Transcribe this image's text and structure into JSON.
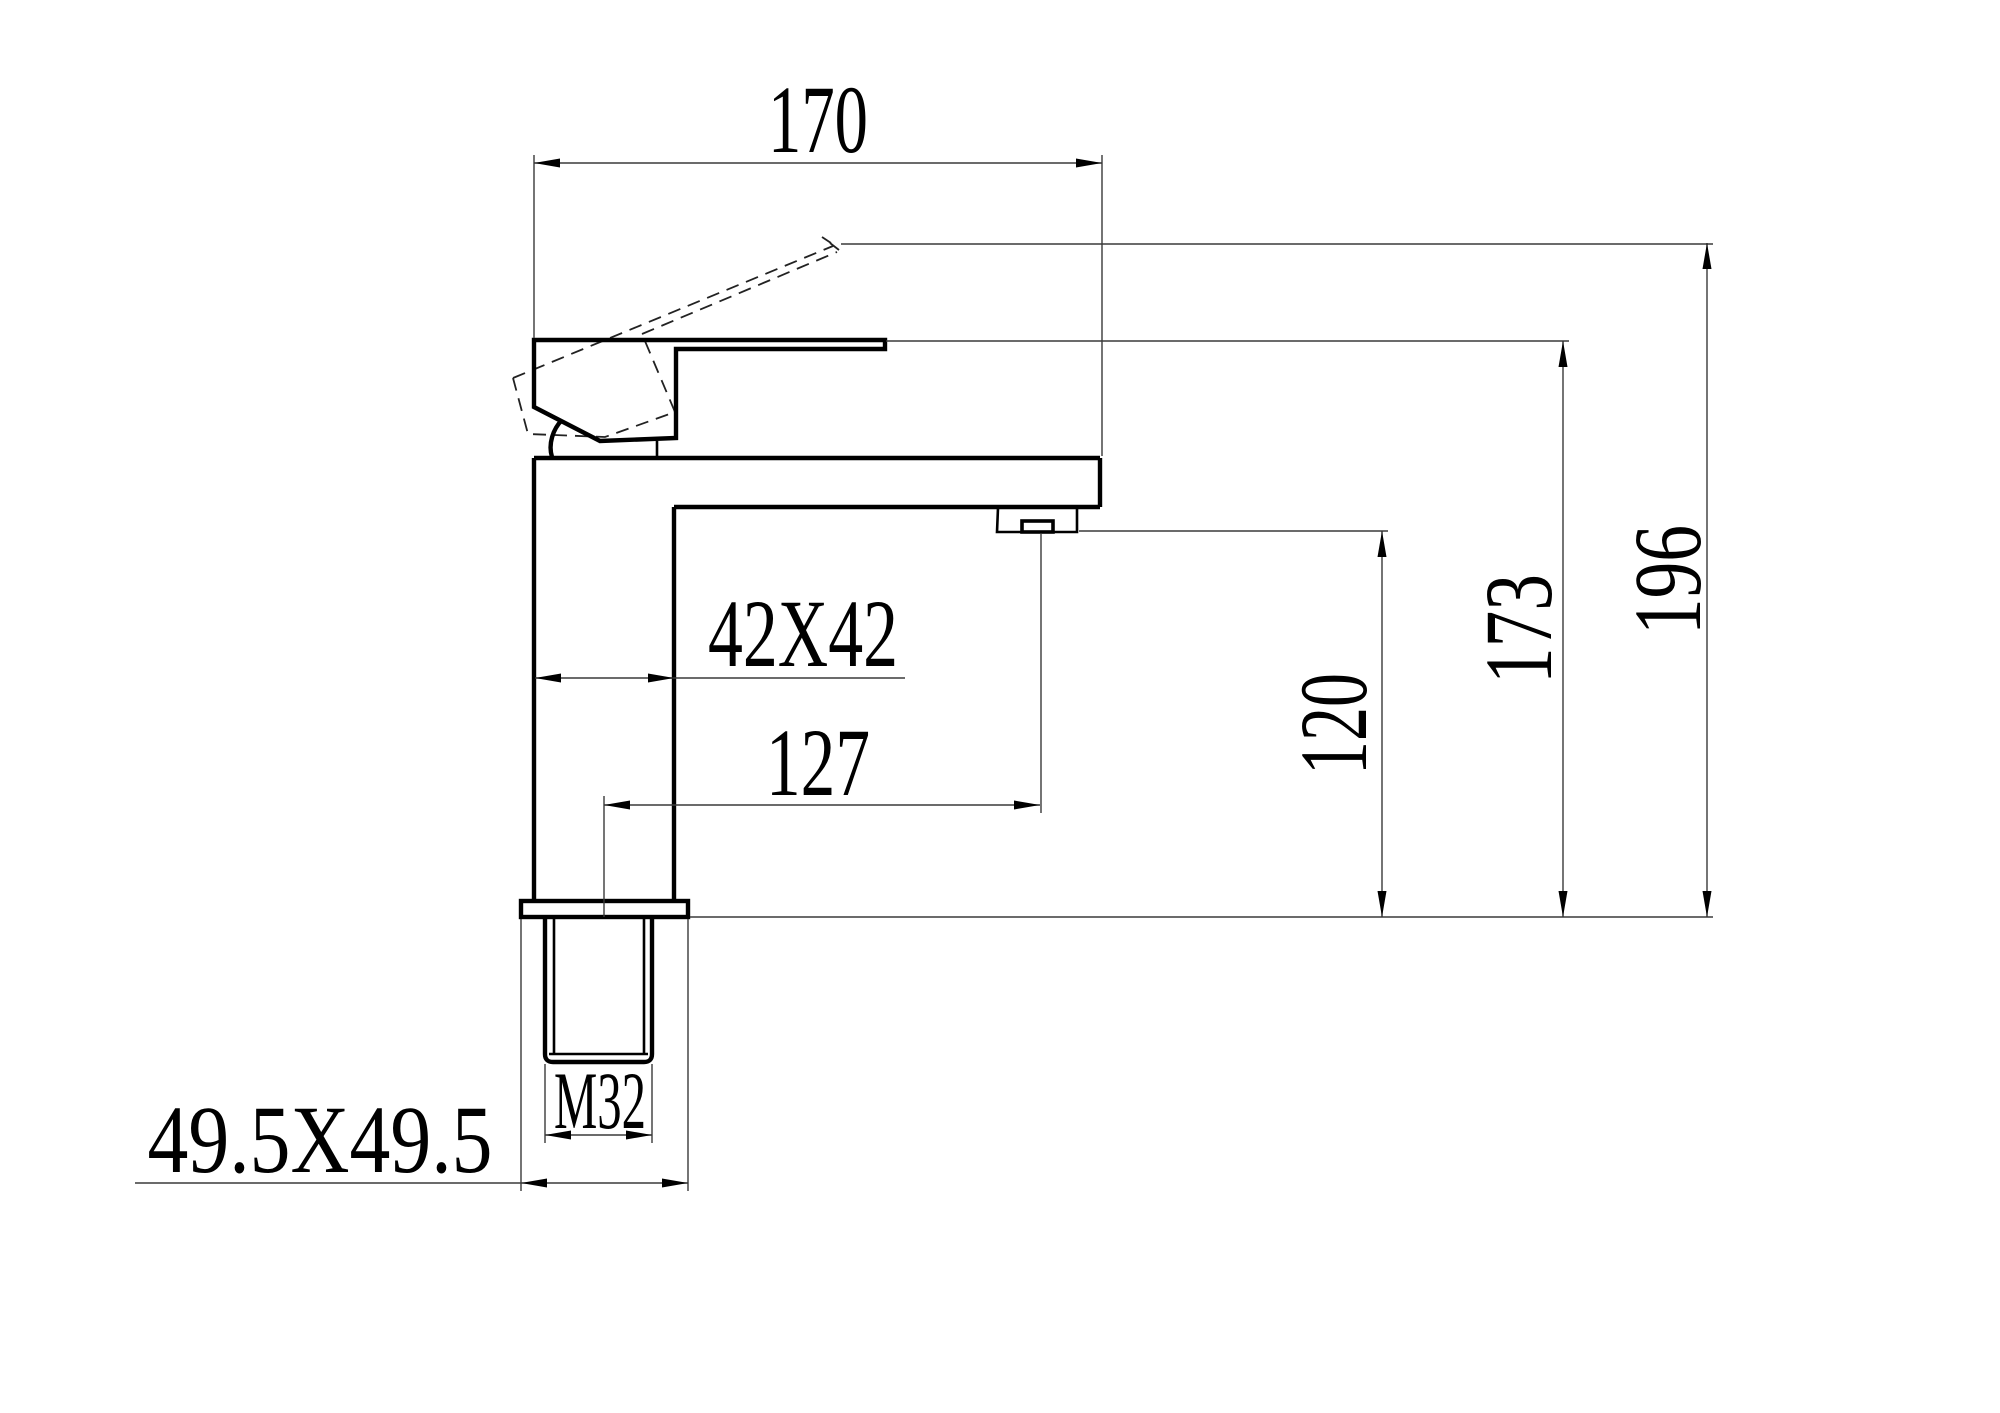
{
  "drawing": {
    "type": "faucet-technical-drawing",
    "dimensions": {
      "top_width": "170",
      "body_section": "42X42",
      "spout_reach": "127",
      "outlet_height": "120",
      "deck_to_body_top": "173",
      "overall_height": "196",
      "thread_size": "M32",
      "base_plate": "49.5X49.5"
    },
    "colors": {
      "line": "#000000",
      "thin_line": "#3a3a3a",
      "background": "#ffffff"
    }
  }
}
